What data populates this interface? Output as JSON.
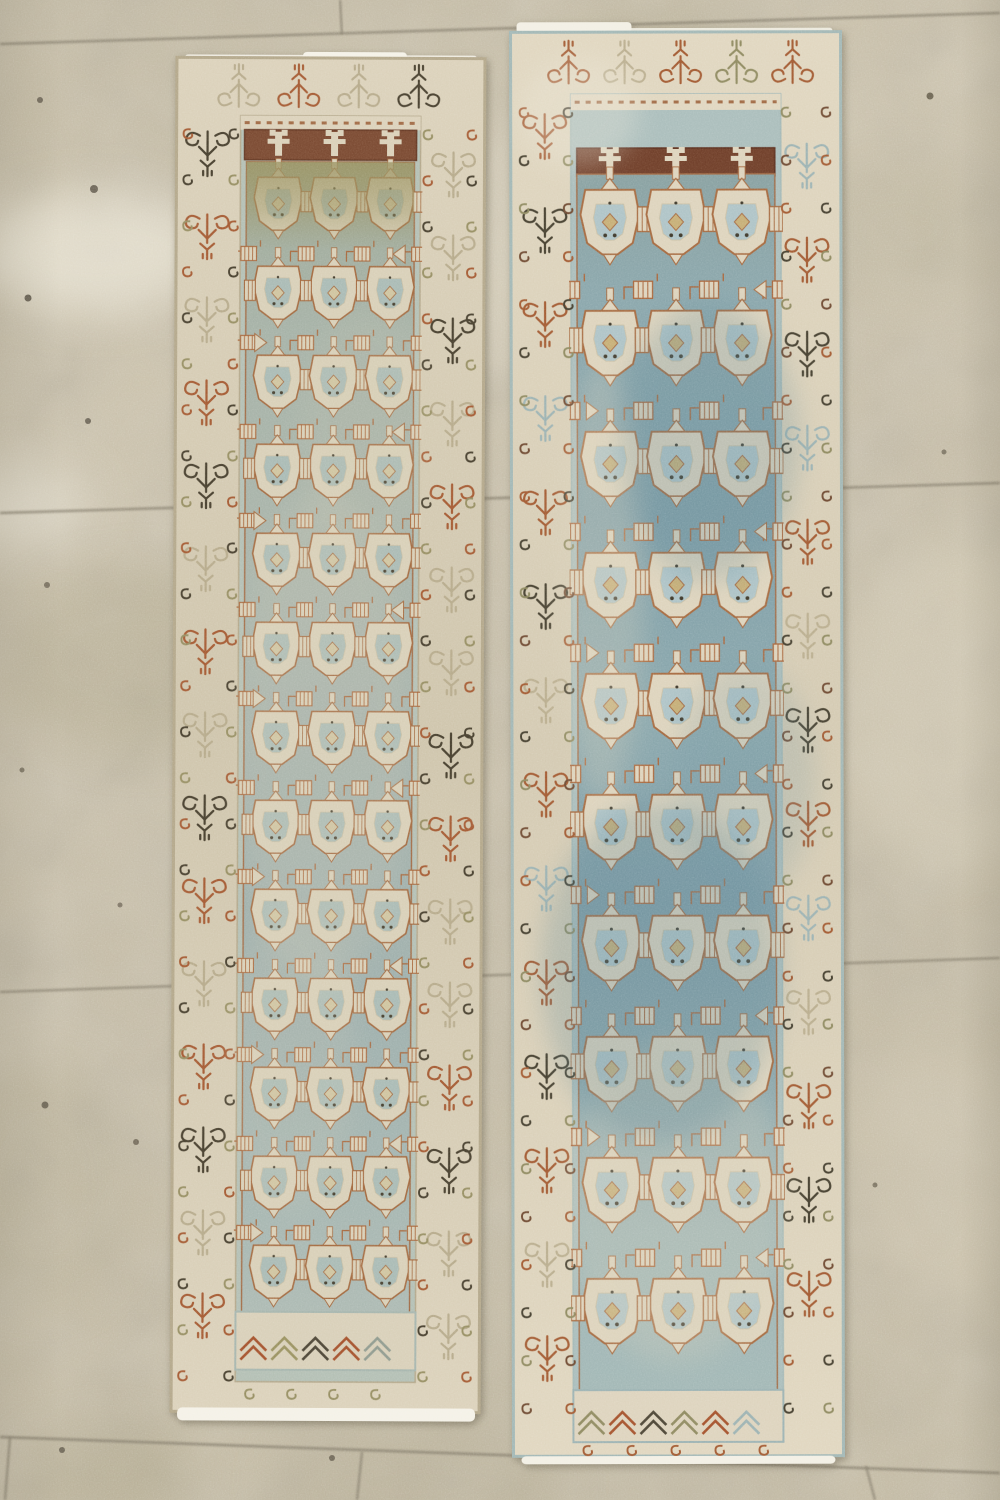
{
  "meta": {
    "description": "Photograph of a pair of antique Persian runner rugs with cream boteh motifs on light blue fields, laid side by side on a beige speckled concrete tile floor"
  },
  "scene": {
    "width": 1000,
    "height": 1500
  },
  "floor": {
    "base": "#c8bfa9",
    "base_gradient": [
      [
        "0",
        "#c2b9a2"
      ],
      [
        "0.3",
        "#cac1ab"
      ],
      [
        "0.62",
        "#c6bda7"
      ],
      [
        "1",
        "#c3baa3"
      ]
    ],
    "grout_color": "#837b6a",
    "grout_lines": [
      {
        "x1": 0,
        "y1": 44,
        "x2": 1000,
        "y2": 13,
        "w": 2.2
      },
      {
        "x1": 0,
        "y1": 513,
        "x2": 1000,
        "y2": 483,
        "w": 2.2
      },
      {
        "x1": 0,
        "y1": 992,
        "x2": 1000,
        "y2": 958,
        "w": 2
      },
      {
        "x1": 0,
        "y1": 1437,
        "x2": 1000,
        "y2": 1473,
        "w": 2.4
      },
      {
        "x1": 340,
        "y1": 0,
        "x2": 342,
        "y2": 34,
        "w": 2
      },
      {
        "x1": 10,
        "y1": 1437,
        "x2": 5,
        "y2": 1500,
        "w": 2
      },
      {
        "x1": 362,
        "y1": 1452,
        "x2": 357,
        "y2": 1500,
        "w": 2
      },
      {
        "x1": 866,
        "y1": 1466,
        "x2": 875,
        "y2": 1500,
        "w": 2
      }
    ],
    "stains": [
      {
        "x": 95,
        "y": 252,
        "rx": 120,
        "ry": 62,
        "c": "#ebe6d7",
        "o": 0.7
      },
      {
        "x": 22,
        "y": 505,
        "rx": 70,
        "ry": 42,
        "c": "#e9e4d5",
        "o": 0.55
      },
      {
        "x": 497,
        "y": 250,
        "rx": 34,
        "ry": 130,
        "c": "#e2dccb",
        "o": 0.4
      },
      {
        "x": 140,
        "y": 660,
        "rx": 140,
        "ry": 95,
        "c": "#9f9777",
        "o": 0.26
      },
      {
        "x": 42,
        "y": 1185,
        "rx": 95,
        "ry": 125,
        "c": "#a8a084",
        "o": 0.2
      },
      {
        "x": 660,
        "y": 55,
        "rx": 115,
        "ry": 50,
        "c": "#a9a185",
        "o": 0.26
      },
      {
        "x": 905,
        "y": 228,
        "rx": 92,
        "ry": 70,
        "c": "#afa78b",
        "o": 0.22
      },
      {
        "x": 955,
        "y": 705,
        "rx": 120,
        "ry": 165,
        "c": "#d9d1bc",
        "o": 0.45
      },
      {
        "x": 420,
        "y": 1482,
        "rx": 150,
        "ry": 62,
        "c": "#aba389",
        "o": 0.28
      },
      {
        "x": 110,
        "y": 1472,
        "rx": 92,
        "ry": 46,
        "c": "#a09878",
        "o": 0.3
      },
      {
        "x": 690,
        "y": 1305,
        "rx": 105,
        "ry": 60,
        "c": "#cfc6b0",
        "o": 0.35
      },
      {
        "x": 935,
        "y": 1180,
        "rx": 90,
        "ry": 140,
        "c": "#d5ccb7",
        "o": 0.4
      }
    ],
    "speckles": [
      {
        "x": 40,
        "y": 100,
        "r": 3,
        "c": "#5f584a"
      },
      {
        "x": 94,
        "y": 189,
        "r": 4,
        "c": "#564f42"
      },
      {
        "x": 28,
        "y": 298,
        "r": 3.5,
        "c": "#4e473b"
      },
      {
        "x": 88,
        "y": 421,
        "r": 3,
        "c": "#5a5346"
      },
      {
        "x": 47,
        "y": 585,
        "r": 3,
        "c": "#6a6252"
      },
      {
        "x": 22,
        "y": 770,
        "r": 2.5,
        "c": "#6c6454"
      },
      {
        "x": 45,
        "y": 1105,
        "r": 3.5,
        "c": "#5c5547"
      },
      {
        "x": 136,
        "y": 1142,
        "r": 3,
        "c": "#665e4e"
      },
      {
        "x": 252,
        "y": 1352,
        "r": 3,
        "c": "#6b6352"
      },
      {
        "x": 930,
        "y": 96,
        "r": 3.5,
        "c": "#57503f"
      },
      {
        "x": 944,
        "y": 452,
        "r": 2.5,
        "c": "#6e6656"
      },
      {
        "x": 770,
        "y": 1403,
        "r": 5,
        "c": "#6e5a4a"
      },
      {
        "x": 707,
        "y": 1442,
        "r": 4,
        "c": "#75614f"
      },
      {
        "x": 540,
        "y": 35,
        "r": 2.5,
        "c": "#6b6353"
      },
      {
        "x": 875,
        "y": 1185,
        "r": 2.5,
        "c": "#6e6655"
      },
      {
        "x": 120,
        "y": 905,
        "r": 2.5,
        "c": "#6f6757"
      },
      {
        "x": 332,
        "y": 1458,
        "r": 3,
        "c": "#60594a"
      },
      {
        "x": 62,
        "y": 1450,
        "r": 3,
        "c": "#5e5748"
      }
    ]
  },
  "rugs": [
    {
      "id": "rug-left",
      "name": "left-runner-rug",
      "x": 172,
      "y": 50,
      "w": 312,
      "h": 1376,
      "rotate": 0.25,
      "palette": {
        "fringe": "#f4f1e7",
        "borderBg": "#dbd1ba",
        "borderBg2": "#cec4ab",
        "edge": "#b3a78a",
        "motifDark": "#473f2e",
        "motifRust": "#a45a33",
        "motifTan": "#b6aa8b",
        "motifBlue": "#a6b5ad",
        "motifOlive": "#968e62",
        "guard": "#b3bfb4",
        "guardLine": "#a06a45",
        "brown": "#7a4931",
        "brownDark": "#643824",
        "bandMotif": "#dad0b8",
        "olive": "#99915f",
        "botehCream": "#d8cfb7",
        "botehOutline": "#a2683e",
        "botehInner": "#a9bab4",
        "botehInnerStroke": "#c6bca1",
        "botehAccent": "#cfc49f",
        "dot": "#453e2e",
        "connector": "#a66337",
        "chevBg": "#d8cfb8",
        "chev": [
          "#a4512c",
          "#99915f",
          "#4c4535",
          "#a4512c",
          "#8f9a8e",
          "#7a4931"
        ],
        "glyph": [
          "#a45a33",
          "#473f2e",
          "#968e62"
        ]
      },
      "geom": {
        "fringe": {
          "x": 128,
          "y": 2,
          "w": 104,
          "h": 9
        },
        "fringeLine": {
          "x": 10,
          "y": 5,
          "w": 292,
          "h": 6
        },
        "body": {
          "x": 2,
          "y": 8,
          "w": 308,
          "h": 1354
        },
        "selvage": {
          "x": 8,
          "y": 1358,
          "w": 298,
          "h": 13
        },
        "borderT": {
          "y": 12,
          "h": 54,
          "cy": 40,
          "start": 64,
          "pitch": 60,
          "count": 4
        },
        "borderL": {
          "x": 6,
          "w": 58,
          "cx": 33,
          "start": 100,
          "end": 1305,
          "pitch": 83
        },
        "borderR": {
          "x": 248,
          "w": 58,
          "cx": 279,
          "start": 120,
          "end": 1305,
          "pitch": 83
        },
        "glyphCols": [
          13,
          59,
          253,
          297
        ],
        "glyphStart": 84,
        "glyphEnd": 1330,
        "glyphStep": 46,
        "guard": {
          "x": 66,
          "y": 66,
          "w": 180,
          "h": 1266
        },
        "vine": {
          "x": 66,
          "y": 66,
          "w": 180,
          "h": 14
        },
        "brown": {
          "x": 70,
          "y": 80,
          "w": 172,
          "h": 30
        },
        "field": {
          "x": 72,
          "y": 112,
          "w": 168,
          "h": 1150
        },
        "fieldStops": [
          [
            "0",
            "#9aa287"
          ],
          [
            "0.05",
            "#a0ab9b"
          ],
          [
            "0.15",
            "#a5b1a6"
          ],
          [
            "0.35",
            "#a8b3a9"
          ],
          [
            "0.55",
            "#a2b0aa"
          ],
          [
            "0.75",
            "#9eafac"
          ],
          [
            "0.9",
            "#a5b5b0"
          ],
          [
            "1",
            "#acb9b2"
          ]
        ],
        "olive": {
          "y": 112,
          "h": 88
        },
        "rows": 13,
        "row0": 154,
        "pitch": 89,
        "colC": [
          104,
          160,
          216
        ],
        "scale": 0.78,
        "chev": {
          "x": 66,
          "y": 1262,
          "w": 180,
          "h": 58,
          "cy": 1294,
          "pitch": 31
        },
        "borderB": {
          "y": 1330,
          "cy": 1344,
          "pitch": 42
        },
        "brownKeysY": 95,
        "brownKeysX": [
          104,
          160,
          216
        ],
        "borderSeqL": [
          "motifDark",
          "motifRust",
          "motifTan",
          "motifRust",
          "motifDark",
          "motifTan",
          "motifRust",
          "motifTan",
          "motifDark",
          "motifRust",
          "motifTan",
          "motifRust",
          "motifDark",
          "motifTan",
          "motifRust"
        ],
        "borderSeqR": [
          "motifTan",
          "motifTan",
          "motifDark",
          "motifTan",
          "motifRust",
          "motifTan",
          "motifTan",
          "motifDark",
          "motifRust",
          "motifTan",
          "motifTan",
          "motifRust",
          "motifDark",
          "motifTan",
          "motifTan"
        ],
        "borderSeqT": [
          "motifTan",
          "motifRust",
          "motifTan",
          "motifDark"
        ],
        "worn": [
          {
            "cx": 150,
            "cy": 690,
            "rx": 85,
            "ry": 250,
            "c": "#d8cfb8",
            "o": 0.16
          },
          {
            "cx": 120,
            "cy": 1010,
            "rx": 65,
            "ry": 150,
            "c": "#d8cfb8",
            "o": 0.14
          },
          {
            "cx": 195,
            "cy": 380,
            "rx": 70,
            "ry": 120,
            "c": "#cfc8ae",
            "o": 0.12
          }
        ]
      }
    },
    {
      "id": "rug-right",
      "name": "right-runner-rug",
      "x": 510,
      "y": 22,
      "w": 336,
      "h": 1442,
      "rotate": -0.12,
      "palette": {
        "fringe": "#f2efe4",
        "borderBg": "#e0d6bf",
        "borderBg2": "#d3c9b1",
        "edge": "#a2b7b5",
        "motifDark": "#453f2f",
        "motifRust": "#a25a32",
        "motifTan": "#b9ad8e",
        "motifBlue": "#9cb2b2",
        "motifOlive": "#8f8a60",
        "guard": "#aabdbb",
        "guardLine": "#a06a45",
        "brown": "#6f3e29",
        "brownDark": "#5b2f1f",
        "bandMotif": "#ddd3bc",
        "olive": "#8d8958",
        "botehCream": "#ddd3bc",
        "botehOutline": "#a5693f",
        "botehInner": "#aec3c6",
        "botehInnerStroke": "#c9bfa4",
        "botehAccent": "#c6ae76",
        "dot": "#3e382a",
        "connector": "#a8663c",
        "chevBg": "#ddd3bd",
        "chev": [
          "#8f8a60",
          "#a4512c",
          "#4c4535",
          "#8f8a60",
          "#a4512c",
          "#9cb2b2",
          "#4c4535"
        ],
        "glyph": [
          "#a25a32",
          "#453f2f",
          "#8f8a60",
          "#6f4a32"
        ]
      },
      "geom": {
        "fringe": {
          "x": 8,
          "y": 0,
          "w": 115,
          "h": 11
        },
        "fringeLine": {
          "x": 8,
          "y": 6,
          "w": 316,
          "h": 6
        },
        "body": {
          "x": 2,
          "y": 10,
          "w": 330,
          "h": 1424
        },
        "selvage": {
          "x": 10,
          "y": 1434,
          "w": 314,
          "h": 8
        },
        "borderT": {
          "y": 14,
          "h": 58,
          "cy": 44,
          "start": 60,
          "pitch": 56,
          "count": 5
        },
        "borderL": {
          "x": 10,
          "w": 52,
          "cx": 36,
          "start": 110,
          "end": 1360,
          "pitch": 94
        },
        "borderR": {
          "x": 272,
          "w": 52,
          "cx": 298,
          "start": 140,
          "end": 1360,
          "pitch": 94
        },
        "glyphCols": [
          15,
          59,
          277,
          317
        ],
        "glyphStart": 90,
        "glyphEnd": 1395,
        "glyphStep": 48,
        "guard": {
          "x": 62,
          "y": 72,
          "w": 210,
          "h": 1306
        },
        "vine": {
          "x": 62,
          "y": 72,
          "w": 210,
          "h": 16
        },
        "oliveZone": {
          "x": 68,
          "y": 88,
          "w": 198,
          "h": 40
        },
        "brown": {
          "x": 68,
          "y": 126,
          "w": 198,
          "h": 28
        },
        "field": {
          "x": 68,
          "y": 152,
          "w": 198,
          "h": 1216
        },
        "fieldStops": [
          [
            "0",
            "#88a0a0"
          ],
          [
            "0.1",
            "#8aa6ab"
          ],
          [
            "0.28",
            "#7e9da6"
          ],
          [
            "0.45",
            "#8aa7ac"
          ],
          [
            "0.6",
            "#7d9ba5"
          ],
          [
            "0.73",
            "#8aa5aa"
          ],
          [
            "0.87",
            "#9db4b4"
          ],
          [
            "1",
            "#a2b7b5"
          ]
        ],
        "olive": {
          "y": 152,
          "h": 0
        },
        "rows": 10,
        "row0": 200,
        "pitch": 121,
        "colC": [
          101,
          167,
          233
        ],
        "scale": 0.95,
        "chev": {
          "x": 62,
          "y": 1368,
          "w": 210,
          "h": 52,
          "cy": 1396,
          "pitch": 31
        },
        "borderB": {
          "y": 1420,
          "cy": 1428,
          "pitch": 44
        },
        "brownKeysY": 140,
        "brownKeysX": [
          101,
          167,
          233
        ],
        "borderSeqL": [
          "motifRust",
          "motifDark",
          "motifRust",
          "motifBlue",
          "motifRust",
          "motifDark",
          "motifTan",
          "motifRust",
          "motifBlue",
          "motifRust",
          "motifDark",
          "motifRust",
          "motifTan",
          "motifRust"
        ],
        "borderSeqR": [
          "motifBlue",
          "motifRust",
          "motifDark",
          "motifBlue",
          "motifRust",
          "motifTan",
          "motifDark",
          "motifRust",
          "motifBlue",
          "motifTan",
          "motifRust",
          "motifDark",
          "motifRust",
          "motifBlue"
        ],
        "borderSeqT": [
          "motifRust",
          "motifTan",
          "motifRust",
          "motifOlive",
          "motifRust"
        ],
        "worn": [
          {
            "cx": 92,
            "cy": 560,
            "rx": 42,
            "ry": 220,
            "c": "#dcd4bd",
            "o": 0.28
          },
          {
            "cx": 165,
            "cy": 1180,
            "rx": 110,
            "ry": 160,
            "c": "#d9d1ba",
            "o": 0.25
          },
          {
            "cx": 70,
            "cy": 90,
            "rx": 60,
            "ry": 55,
            "c": "#eee9da",
            "o": 0.3
          },
          {
            "cx": 200,
            "cy": 420,
            "rx": 90,
            "ry": 140,
            "c": "#5f8795",
            "o": 0.25
          },
          {
            "cx": 150,
            "cy": 950,
            "rx": 120,
            "ry": 170,
            "c": "#5f8795",
            "o": 0.28
          },
          {
            "cx": 235,
            "cy": 760,
            "rx": 70,
            "ry": 120,
            "c": "#6d93a0",
            "o": 0.2
          }
        ]
      }
    }
  ]
}
